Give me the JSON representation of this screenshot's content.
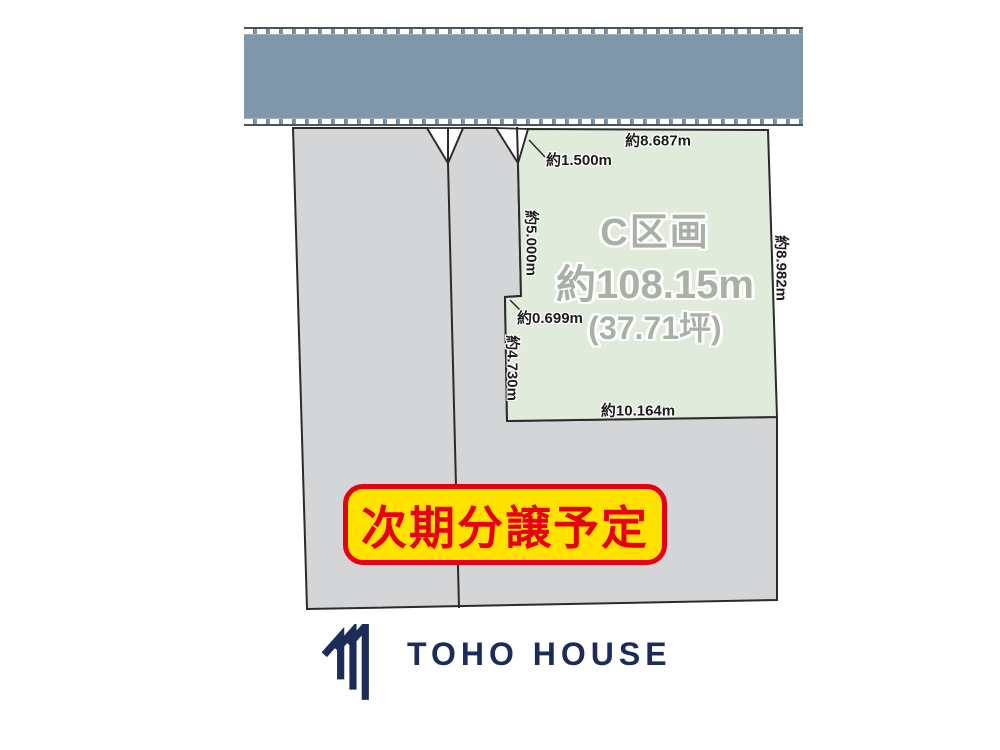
{
  "plot": {
    "name": "C区画",
    "area": "約108.15m",
    "area_tsubo": "(37.71坪)"
  },
  "dimensions": {
    "top_edge": "約8.687m",
    "corner_cut": "約1.500m",
    "left_upper": "約5.000m",
    "left_step": "約0.699m",
    "left_lower": "約4.730m",
    "bottom_edge": "約10.164m",
    "right_edge": "約8.982m"
  },
  "banner": {
    "label": "次期分譲予定"
  },
  "footer": {
    "brand": "TOHO HOUSE"
  },
  "icons": {
    "logo_mark": "toho-house-roof-mark"
  },
  "colors": {
    "road_fill": "#7E98A9",
    "plot_fill": "#E1EBDB",
    "reserved_fill": "#D4D5D7",
    "outline": "#2B2B2B",
    "banner_fill": "#FFE100",
    "banner_red": "#E60012",
    "brand_navy": "#1D2B5A",
    "plot_label_gray": "#A9B1A7"
  }
}
